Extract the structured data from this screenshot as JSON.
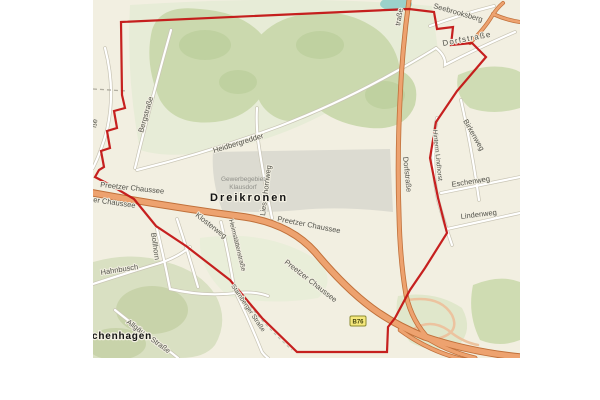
{
  "map": {
    "place_labels": {
      "dreikronen": "Dreikronen",
      "chenhagen": "chenhagen"
    },
    "area_labels": {
      "gewerbegebiet_line1": "Gewerbegebiet",
      "gewerbegebiet_line2": "Klausdorf"
    },
    "street_labels": {
      "bergstrasse": "Bergstraße",
      "heidbergredder": "Heidbergredder",
      "liesenhornweg": "Liesenhornweg",
      "preetzer_chaussee_1": "Preetzer Chaussee",
      "chaussee_fragment": "er Chaussee",
      "preetzer_chaussee_2": "Preetzer Chaussee",
      "preetzer_chaussee_3": "Preetzer Chaussee",
      "dorfstrasse_vertical": "Dorfstraße",
      "dorfstrasse_diagonal": "Dorfstraße",
      "seebrooksberg": "Seebrooksberg",
      "strasse_fragment_top": "traße",
      "strasse_fragment_left": "ße",
      "birkenweg": "Birkenweg",
      "eschenweg": "Eschenweg",
      "lindenweg": "Lindenweg",
      "hinterm_lindhorst": "Hinterm Lindhorst",
      "klosterweg": "Klosterweg",
      "bollhorn": "Bollhorn",
      "heimstaettenstrasse": "Heimstättenstraße",
      "starnberger_strasse": "Starnberger Straße",
      "hahnbusch": "Hahnbusch",
      "allgaeuer_strasse": "Allgäuer Straße"
    },
    "route_shield": {
      "label": "B76"
    },
    "colors": {
      "boundary": "#c31414",
      "road_major_fill": "#eda26f",
      "road_major_casing": "#c0703a",
      "road_minor_fill": "#ffffff",
      "road_minor_casing": "#c9c5b5",
      "water": "#9bd1ca",
      "forest": "#cbd9ae",
      "industrial_area": "#dcdbd1",
      "background": "#f2efe1",
      "shield_bg": "#f5e87b"
    }
  }
}
